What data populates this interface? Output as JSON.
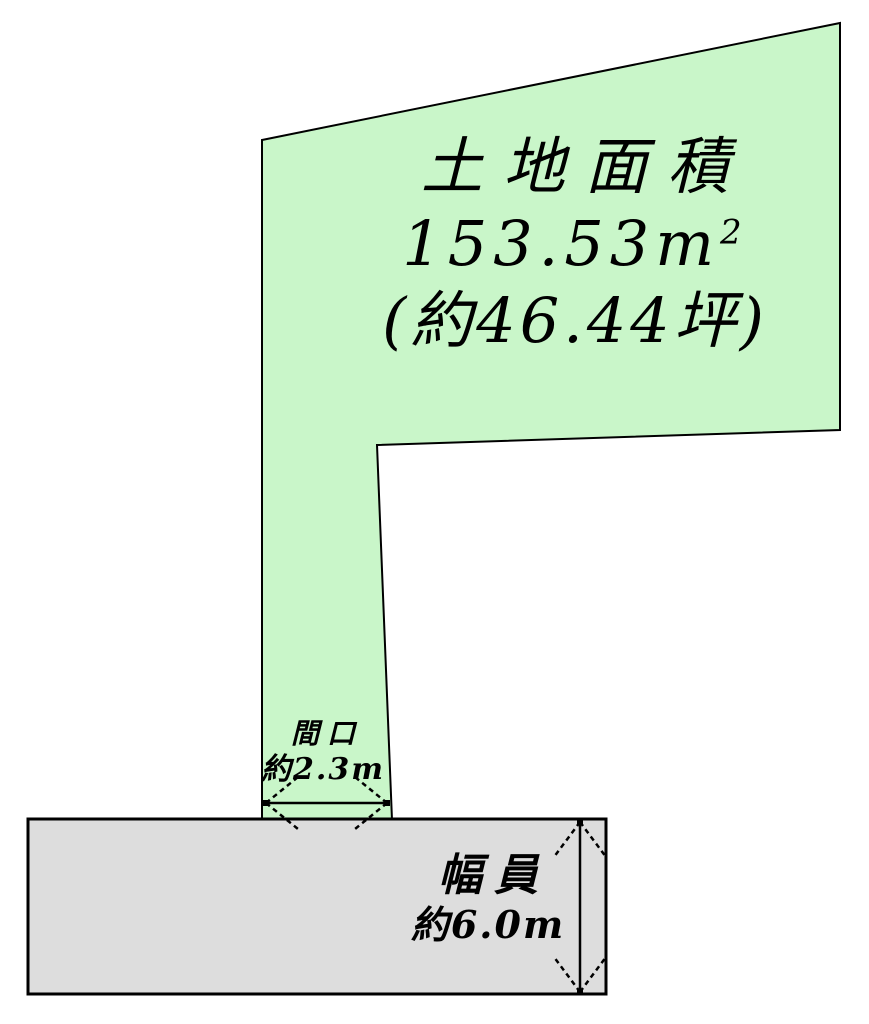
{
  "land": {
    "title": "土地面積",
    "area_value": "153.53",
    "area_unit": "m",
    "area_unit_exp": "2",
    "area_tsubo": "(約46.44坪)"
  },
  "frontage": {
    "label": "間口",
    "value": "約2.3m"
  },
  "road": {
    "label": "幅員",
    "value": "約6.0m"
  },
  "colors": {
    "land_fill": "#c9f6c9",
    "road_fill": "#dddddd",
    "outline": "#000000"
  }
}
